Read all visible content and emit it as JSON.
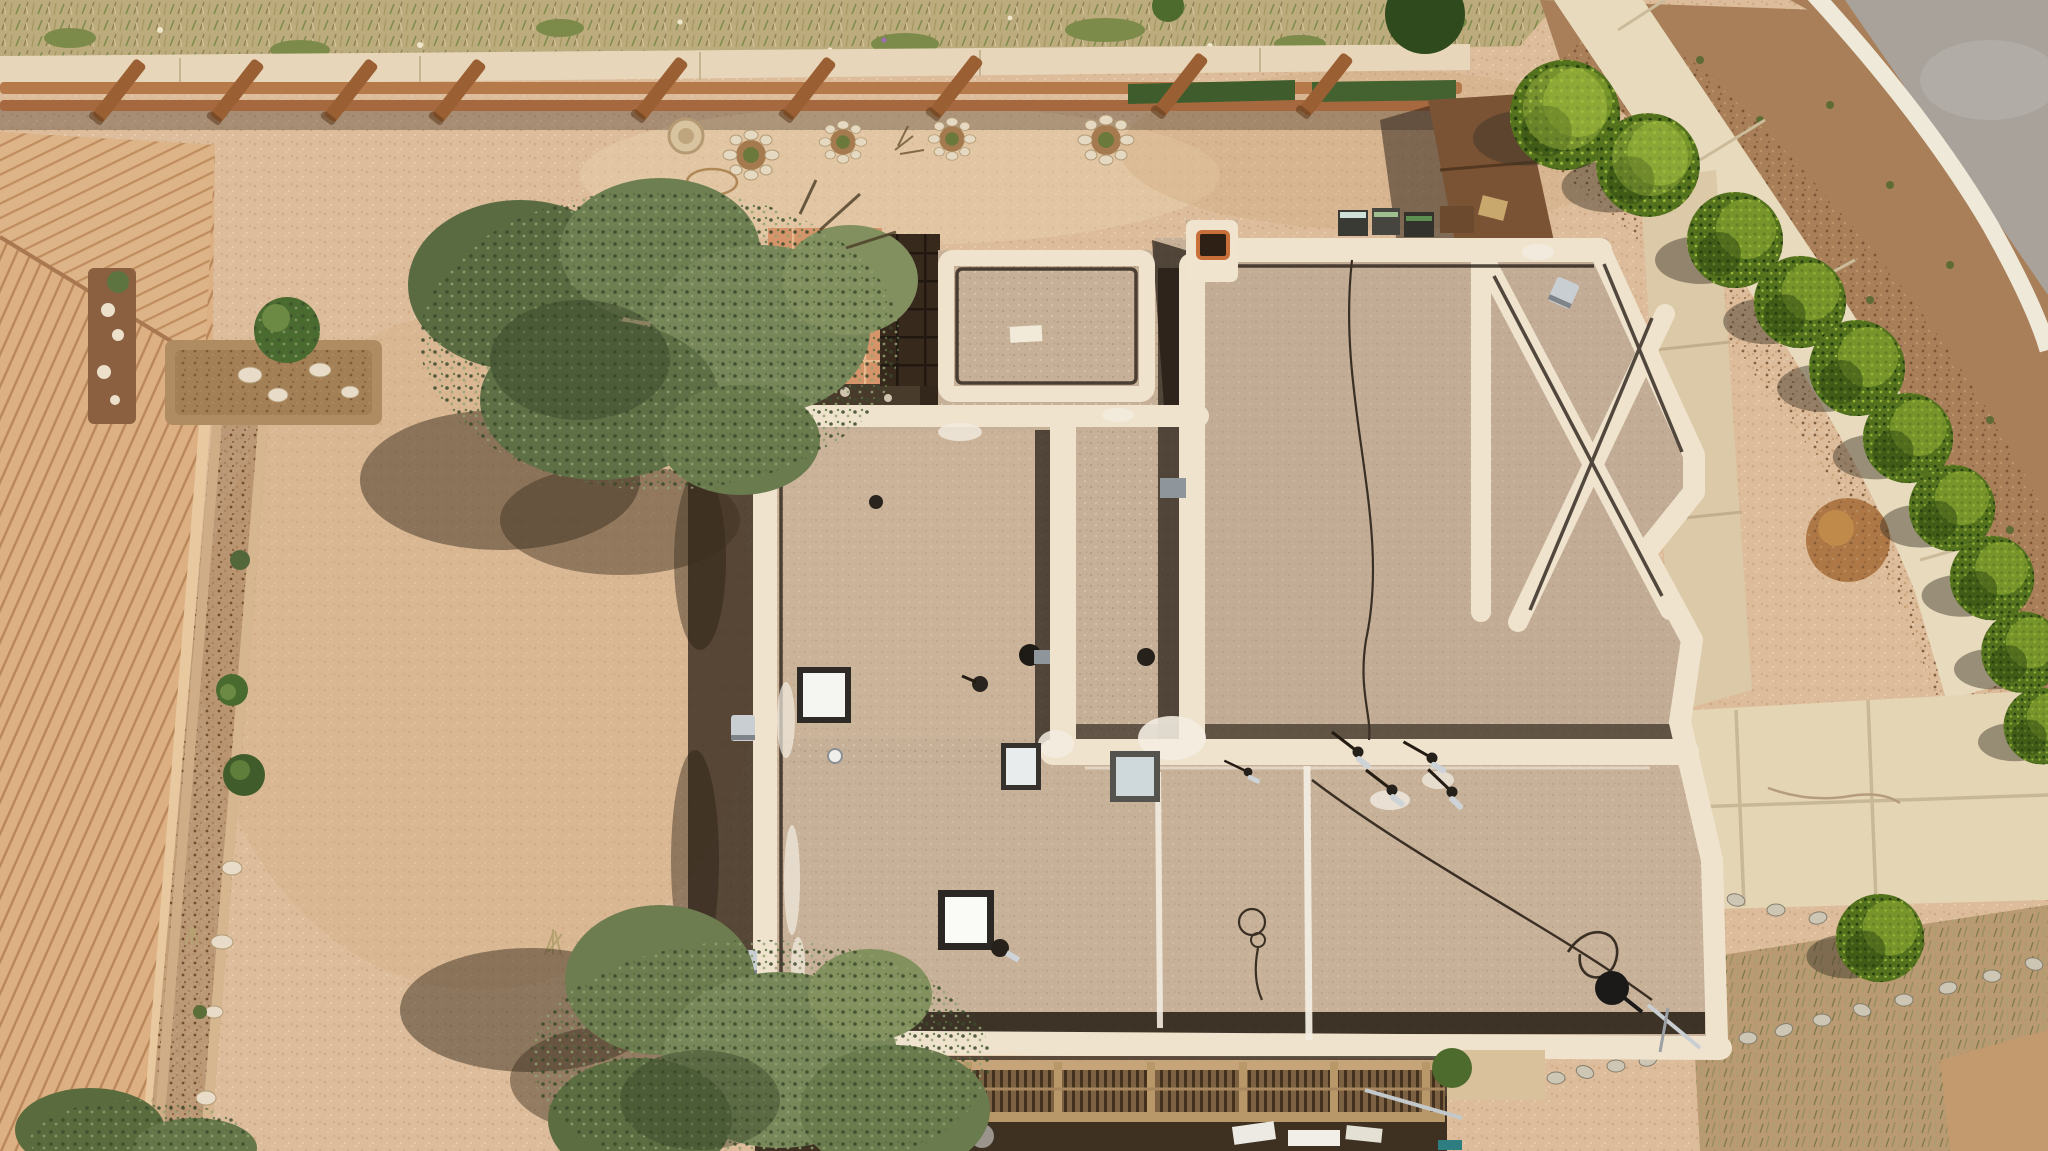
{
  "meta": {
    "type": "aerial-drone-photograph",
    "subject": "Top-down view of a flat-roofed southwestern adobe house with gravel backyard, wooden deck, pergola, curved street corner with evergreen hedge row, and driveway"
  },
  "palette": {
    "gravel_yard": "#dcbc9a",
    "roof_base": "#c6b098",
    "parapet": "#efe3cd",
    "shadow": "#241a10",
    "tile": "#d6946a",
    "cover": "#38291d",
    "deck": "#ddb388",
    "bed_mulch": "#8a6040",
    "fence": "#b5794a",
    "tall_fence": "#7a5335",
    "turf": "#3f5d2c",
    "grass": "#bcab7c",
    "curb_strip": "#e7d6ba",
    "mulch": "#a87f58",
    "sidewalk": "#e8dbbd",
    "curb": "#efe9d9",
    "asphalt": "#a8a29b",
    "driveway": "#e4d5b5",
    "path": "#dcc9a8",
    "evergreen": "#55721f",
    "juniper": "#6d7d4f",
    "pergola_beam": "#c4a478",
    "chimney_flue": "#c96f3a",
    "skylight_white": "#f5f5f2",
    "skylight_blue": "#cfd8da",
    "dish_black": "#1c1a18",
    "stucco_wall": "#d9c19c",
    "canale_metal": "#c9ced2",
    "caulk_white": "#f3ece1"
  },
  "scene": {
    "regions": [
      {
        "name": "dry-grass-strip",
        "desc": "dry weedy grass band along top edge"
      },
      {
        "name": "split-rail-fence",
        "desc": "horizontal wooden fence with diagonal braces and green turf strips"
      },
      {
        "name": "backyard-gravel",
        "desc": "large tan gravel yard"
      },
      {
        "name": "wood-deck",
        "desc": "diagonal-plank wooden deck along left edge with planter beds and stones"
      },
      {
        "name": "house-roof",
        "desc": "flat gravel roof with cream parapet walls, skylights, vents, chimney, canales and diamond parapet bay"
      },
      {
        "name": "tiled-patio",
        "desc": "terracotta tiled patio with dark shade cover"
      },
      {
        "name": "pergola",
        "desc": "slatted shade pergola along south side with patio below"
      },
      {
        "name": "street-corner",
        "desc": "curved asphalt street, white curb, mulch bed, concrete sidewalk"
      },
      {
        "name": "evergreen-row",
        "desc": "arc of sheared evergreen trees along sidewalk"
      },
      {
        "name": "driveway",
        "desc": "concrete driveway with rock borders and mulch"
      }
    ]
  }
}
